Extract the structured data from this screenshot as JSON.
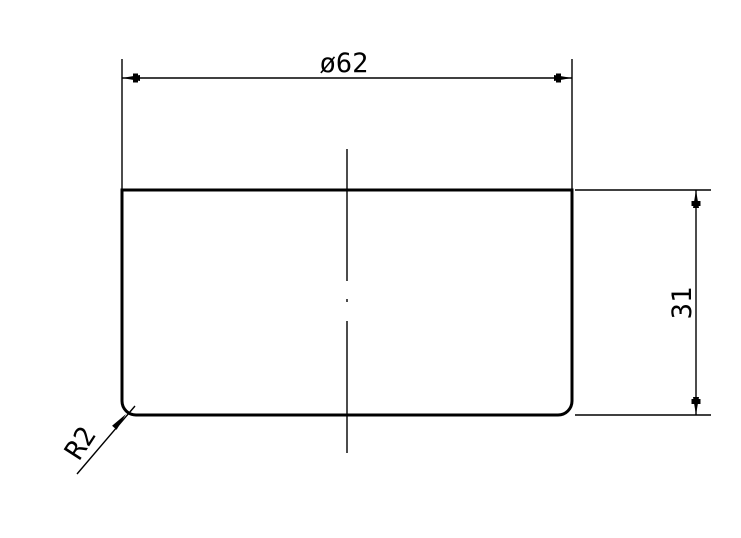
{
  "page": {
    "background_color": "#ffffff",
    "stroke_color": "#000000"
  },
  "drawing": {
    "kind": "engineering cross-section view of a cylindrical part",
    "labels": {
      "diameter": "ø62",
      "height": "31",
      "fillet_radius": "R2"
    },
    "values": {
      "diameter_mm": 62,
      "height_mm": 31,
      "fillet_radius_mm": 2
    }
  }
}
